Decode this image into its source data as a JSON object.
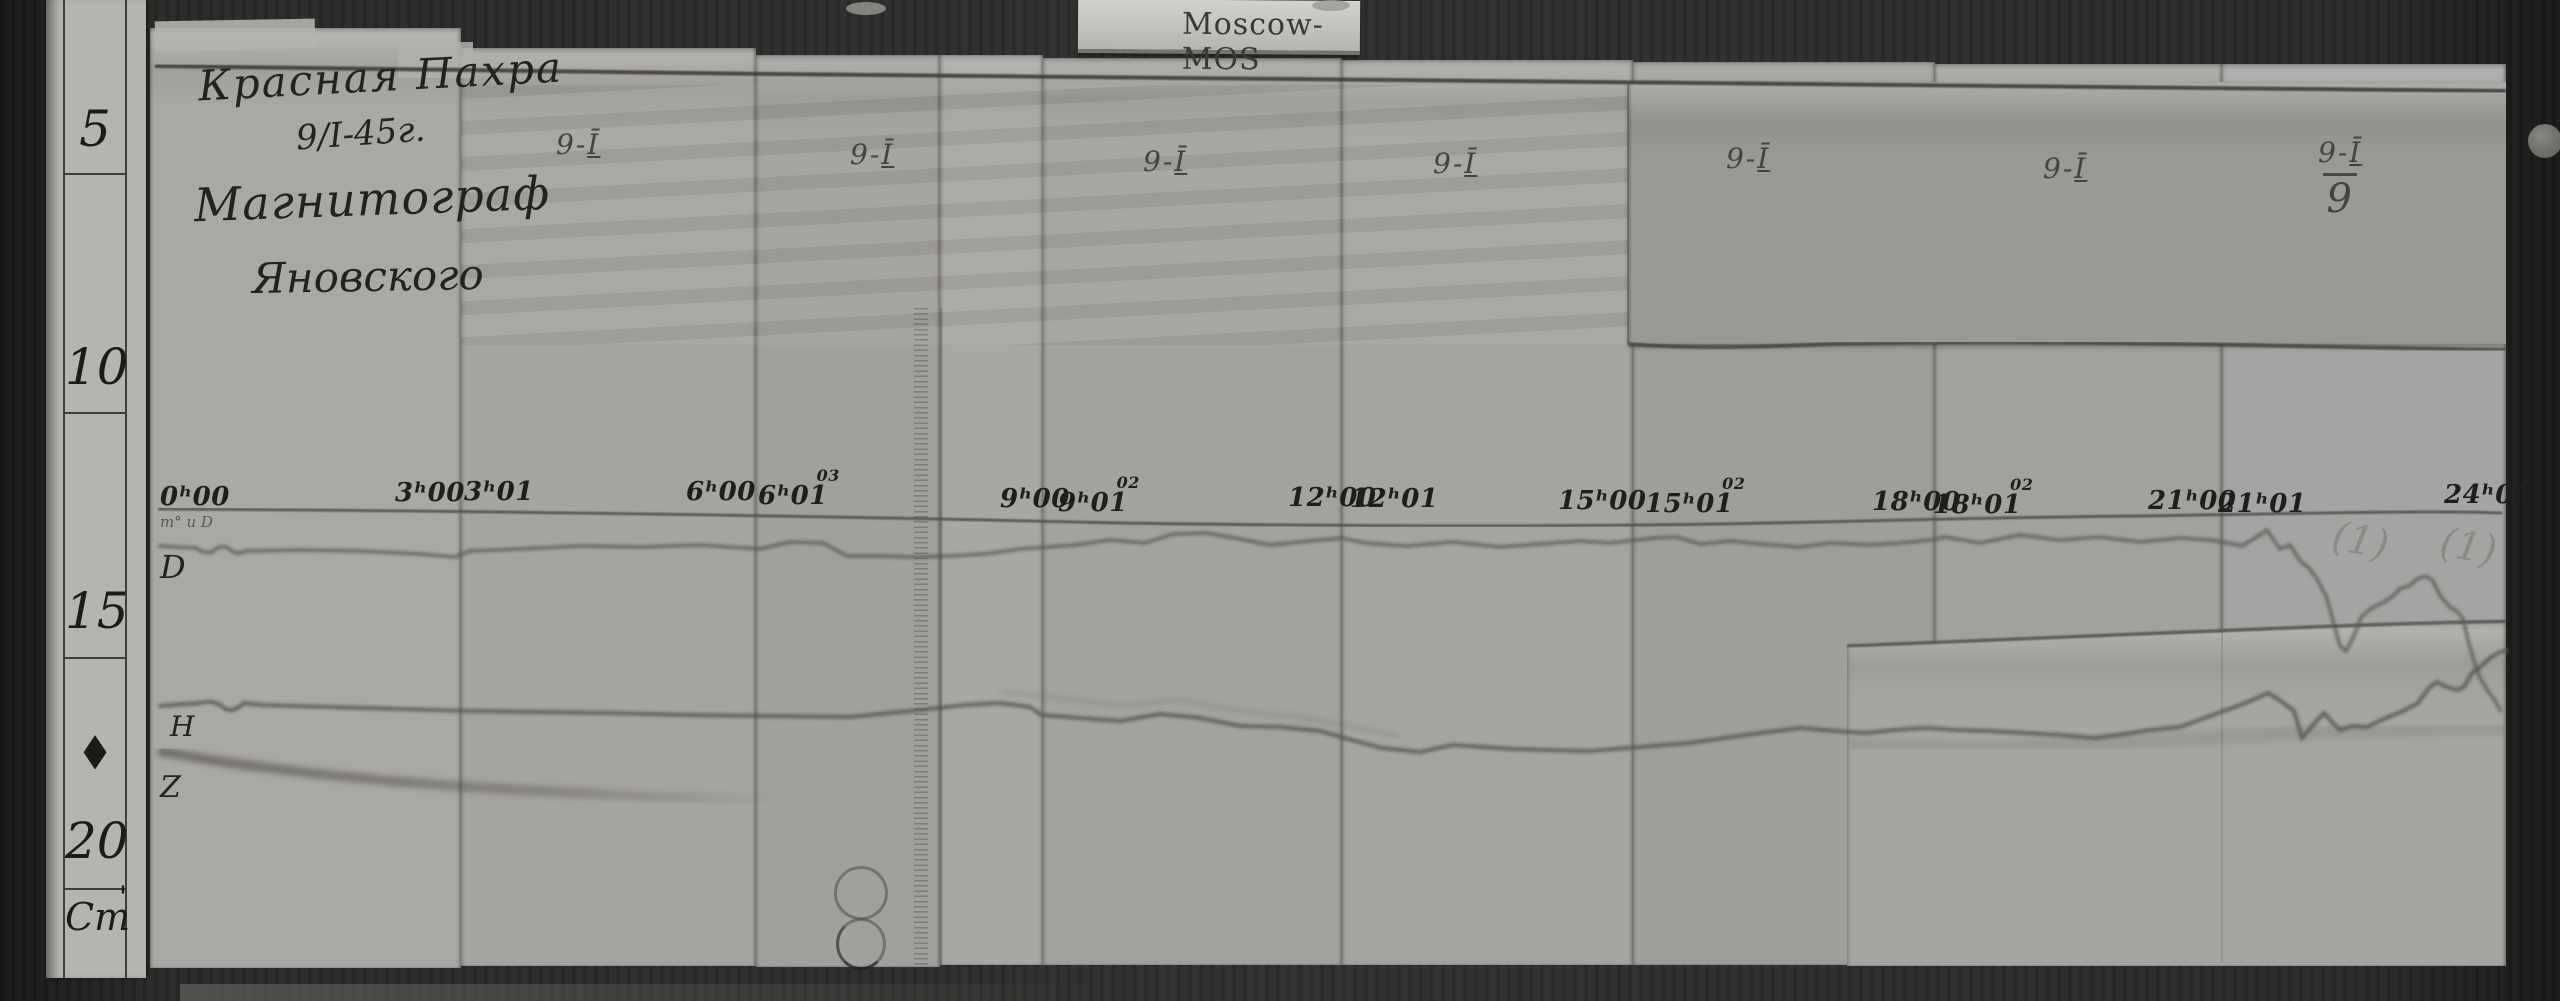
{
  "label_card": {
    "text": "Moscow-MOS"
  },
  "ruler": {
    "marks": [
      {
        "v": "5"
      },
      {
        "v": "10"
      },
      {
        "v": "15"
      },
      {
        "v": "20"
      }
    ],
    "unit": "Cm",
    "tick": "'",
    "diamond": "◆"
  },
  "title_block": {
    "line1": "Красная Пахра",
    "line2": "9/I-45г.",
    "line3": "Магнитограф",
    "line4": "Яновского"
  },
  "headers": [
    {
      "prefix": "9-",
      "numeral": "Ī",
      "denominator": ""
    },
    {
      "prefix": "9-",
      "numeral": "Ī",
      "denominator": ""
    },
    {
      "prefix": "9-",
      "numeral": "Ī",
      "denominator": ""
    },
    {
      "prefix": "9-",
      "numeral": "Ī",
      "denominator": ""
    },
    {
      "prefix": "9-",
      "numeral": "Ī",
      "denominator": ""
    },
    {
      "prefix": "9-",
      "numeral": "Ī",
      "denominator": ""
    },
    {
      "prefix": "9-",
      "numeral": "Ī",
      "denominator": "9"
    }
  ],
  "timeline": {
    "labels": [
      {
        "main": "0ʰ00",
        "sup": ""
      },
      {
        "main": "3ʰ00",
        "sup": ""
      },
      {
        "main": "3ʰ01",
        "sup": ""
      },
      {
        "main": "6ʰ00",
        "sup": ""
      },
      {
        "main": "6ʰ01",
        "sup": "03"
      },
      {
        "main": "9ʰ00",
        "sup": ""
      },
      {
        "main": "9ʰ01",
        "sup": "02"
      },
      {
        "main": "12ʰ00",
        "sup": ""
      },
      {
        "main": "12ʰ01",
        "sup": ""
      },
      {
        "main": "15ʰ00",
        "sup": ""
      },
      {
        "main": "15ʰ01",
        "sup": "02"
      },
      {
        "main": "18ʰ00",
        "sup": ""
      },
      {
        "main": "18ʰ01",
        "sup": "02"
      },
      {
        "main": "21ʰ00",
        "sup": ""
      },
      {
        "main": "21ʰ01",
        "sup": ""
      },
      {
        "main": "24ʰ00",
        "sup": ""
      }
    ]
  },
  "trace_labels": {
    "note": "т° и D",
    "d": "D",
    "h": "H",
    "z": "Z"
  },
  "pencil_marks": [
    {
      "text": "(1)"
    },
    {
      "text": "(1)"
    }
  ],
  "colors": {
    "paper": "#a5a3a0",
    "wood": "#2b2a28",
    "ink": "#232220",
    "trace": "#55524e"
  },
  "traces": {
    "top_line": "M155,66 C700,74 1300,80 1800,84 C2150,87 2420,89 2506,91",
    "baseline": "M158,509 C520,511 820,516 1120,523 C1320,526 1520,527 1720,524 C1880,521 2000,517 2140,516 C2280,514 2420,510 2502,513",
    "d_trace": "M158,546 L196,548 Q204,554 212,552 Q220,544 228,548 Q236,556 246,551 L300,550 L360,551 L420,554 L455,557 L470,551 L520,549 L580,546 L640,547 L700,545 L760,549 L790,542 L823,543 L847,556 L880,556 L913,557 L950,556 L985,554 L1020,549 L1047,547 L1075,545 L1110,540 L1145,543 L1173,534 L1207,533 L1240,539 L1270,545 L1310,541 L1342,538 L1365,543 L1407,546 L1453,542 L1500,547 L1540,544 L1580,541 L1610,543 L1637,540 L1655,538 L1677,537 L1700,544 L1730,541 L1760,544 L1800,547 L1830,543 L1870,545 L1900,543 L1930,540 L1945,537 L1980,543 L2020,535 L2060,540 L2100,537 L2140,542 L2180,538 L2210,540 L2228,543 L2242,546 L2255,538 L2267,530 L2280,549 L2290,545 L2301,562 L2309,568 L2317,579 L2327,598 L2336,632 L2340,646 L2346,651 L2353,638 L2362,616 L2372,608 L2384,602 L2393,596 L2401,588 L2409,586 L2417,579 L2426,576 L2433,581 L2441,597 L2451,608 L2457,611 L2463,619 L2469,644 L2474,661 L2480,678 L2488,691 L2496,702 L2501,712",
    "h_trace": "M158,706 L200,703 Q214,699 224,708 Q232,714 244,703 L262,705 L330,707 L400,709 L470,711 L540,712 L610,713 L690,715 L770,716 L850,717 L920,710 L965,705 L1000,703 L1030,707 L1042,715 L1080,718 L1120,721 L1160,714 L1200,718 L1240,726 L1280,727 L1320,731 L1348,739 L1382,748 L1420,752 L1452,745 L1484,747 L1512,749 L1545,750 L1590,751 L1640,747 L1690,743 L1745,735 L1800,728 L1835,731 L1865,733 L1895,730 L1925,728 L1958,730 L1990,731 L2025,733 L2060,735 L2095,738 L2125,734 L2150,730 L2180,727 L2210,716 L2235,707 L2255,699 L2268,693 L2281,701 L2294,711 L2302,738 L2313,725 L2324,713 L2332,722 L2340,730 L2352,726 L2367,727 L2386,718 L2401,712 L2418,703 L2429,688 L2437,682 L2447,687 L2457,690 L2464,687 L2472,673 L2480,667 L2490,658 L2500,652 L2509,650",
    "h_faint": "M1000,691 L1060,698 L1120,706 L1180,700 L1240,711 L1300,717 L1350,726 L1400,737",
    "z_trace": "M158,751 L230,763 L310,773 L390,781 L470,787 L560,792 L660,797 L770,801",
    "smear": "M1850,746 L2000,748 L2150,741 L2300,733 L2430,729 L2505,727",
    "overlay_tr_bottom": "M1628,344 C1690,349 1760,347 1830,344 C1990,341 2150,343 2290,346 C2390,348 2460,349 2506,350",
    "overlay_br_top": "M1847,646 C2010,640 2160,633 2310,627 C2410,623 2470,622 2506,621"
  }
}
